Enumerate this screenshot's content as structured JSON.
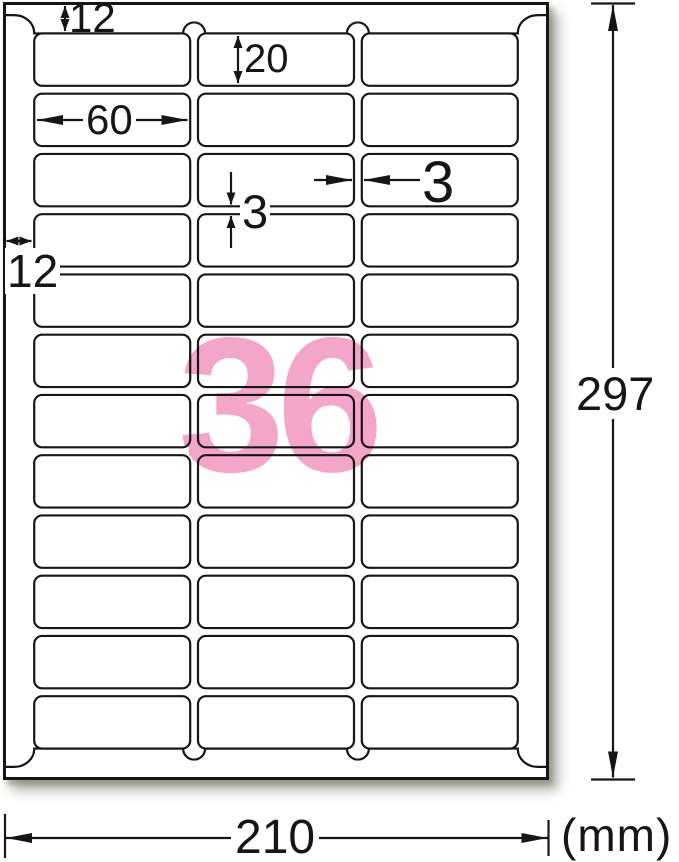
{
  "sheet": {
    "count_label": "36",
    "rows": 12,
    "cols": 3
  },
  "geometry_mm": {
    "page_w": 210,
    "page_h": 297,
    "label_w": 60,
    "label_h": 20,
    "gap": 3,
    "margin": 12
  },
  "dims": {
    "top_margin": "12",
    "label_height": "20",
    "label_width": "60",
    "col_gap": "3",
    "row_gap": "3",
    "left_margin": "12",
    "page_height": "297",
    "page_width": "210",
    "unit": "(mm)"
  },
  "colors": {
    "pink": "#f3a6c9",
    "line": "#161616"
  }
}
